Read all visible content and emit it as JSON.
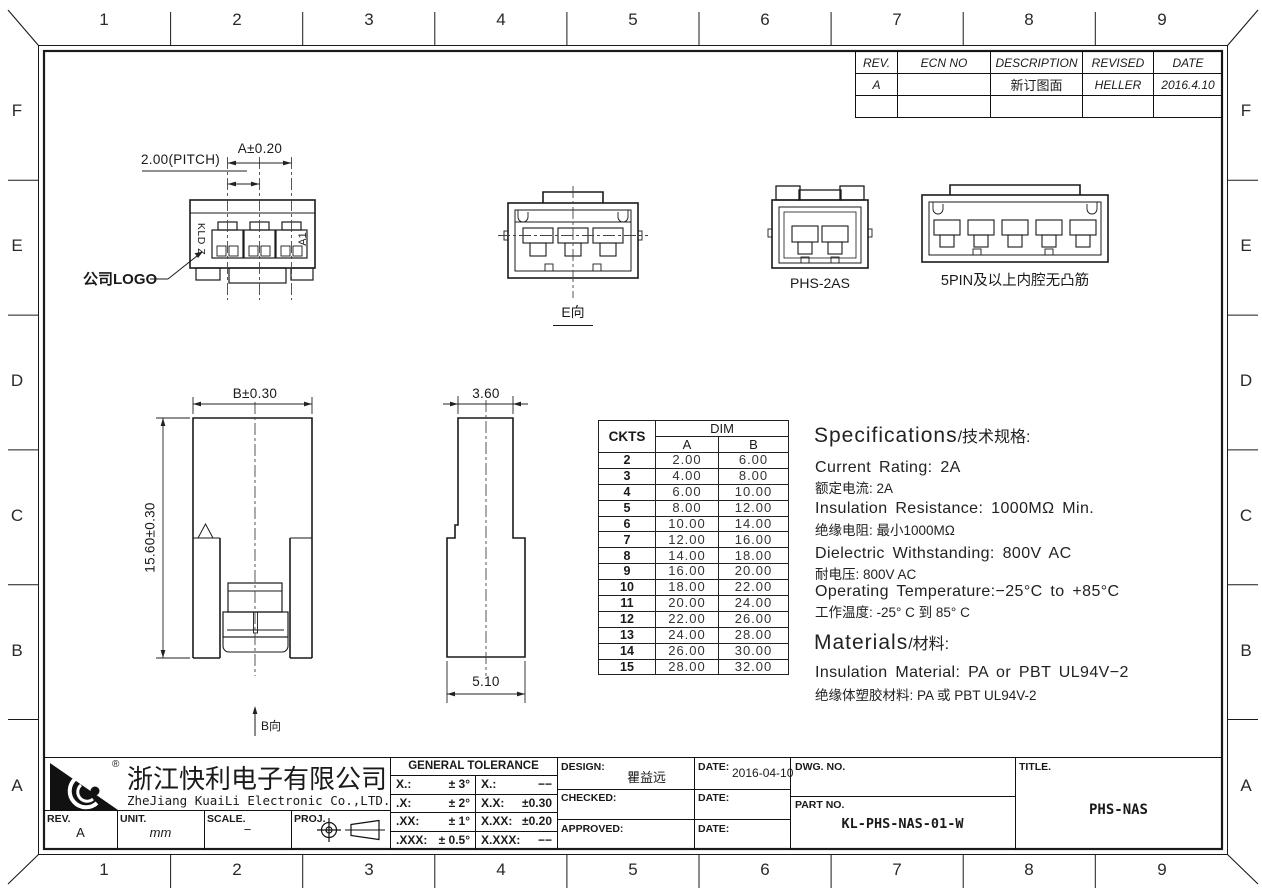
{
  "grid": {
    "cols": [
      "1",
      "2",
      "3",
      "4",
      "5",
      "6",
      "7",
      "8",
      "9"
    ],
    "rows": [
      "F",
      "E",
      "D",
      "C",
      "B",
      "A"
    ]
  },
  "revision_table": {
    "headers": [
      "REV.",
      "ECN NO",
      "DESCRIPTION",
      "REVISED",
      "DATE"
    ],
    "rows": [
      [
        "A",
        "",
        "新订图面",
        "HELLER",
        "2016.4.10"
      ],
      [
        "",
        "",
        "",
        "",
        ""
      ]
    ]
  },
  "views": {
    "top_view": {
      "pitch_dim": "2.00(PITCH)",
      "a_dim": "A±0.20",
      "left_marking": "KLD Z",
      "right_marking": "A1",
      "logo_callout": "公司LOGO"
    },
    "e_view": {
      "label": "E向"
    },
    "phs_2as": {
      "label": "PHS-2AS"
    },
    "five_pin": {
      "label": "5PIN及以上内腔无凸筋"
    },
    "b_view": {
      "width_dim": "B±0.30",
      "height_dim": "15.60±0.30",
      "label": "B向"
    },
    "side_view": {
      "top_dim": "3.60",
      "bottom_dim": "5.10"
    }
  },
  "dim_table": {
    "ckts_header": "CKTS",
    "dim_header": "DIM",
    "col_a": "A",
    "col_b": "B",
    "rows": [
      [
        "2",
        "2.00",
        "6.00"
      ],
      [
        "3",
        "4.00",
        "8.00"
      ],
      [
        "4",
        "6.00",
        "10.00"
      ],
      [
        "5",
        "8.00",
        "12.00"
      ],
      [
        "6",
        "10.00",
        "14.00"
      ],
      [
        "7",
        "12.00",
        "16.00"
      ],
      [
        "8",
        "14.00",
        "18.00"
      ],
      [
        "9",
        "16.00",
        "20.00"
      ],
      [
        "10",
        "18.00",
        "22.00"
      ],
      [
        "11",
        "20.00",
        "24.00"
      ],
      [
        "12",
        "22.00",
        "26.00"
      ],
      [
        "13",
        "24.00",
        "28.00"
      ],
      [
        "14",
        "26.00",
        "30.00"
      ],
      [
        "15",
        "28.00",
        "32.00"
      ]
    ]
  },
  "specs": {
    "title_en": "Specifications",
    "title_cn": "/技术规格:",
    "current_en": "Current Rating: 2A",
    "current_cn": "额定电流: 2A",
    "insulation_en": "Insulation Resistance: 1000MΩ Min.",
    "insulation_cn": "绝缘电阻: 最小1000MΩ",
    "dielectric_en": "Dielectric Withstanding: 800V AC",
    "dielectric_cn": "耐电压: 800V AC",
    "temp_en": "Operating Temperature:−25°C to +85°C",
    "temp_cn": "工作温度: -25° C 到 85° C",
    "materials_title_en": "Materials",
    "materials_title_cn": "/材料:",
    "material_en": "Insulation Material: PA or PBT UL94V−2",
    "material_cn": "绝缘体塑胶材料: PA 或 PBT UL94V-2"
  },
  "title_block": {
    "company_cn": "浙江快利电子有限公司",
    "company_en": "ZheJiang KuaiLi Electronic Co.,LTD.",
    "registered": "®",
    "rev_label": "REV.",
    "rev_value": "A",
    "unit_label": "UNIT.",
    "unit_value": "mm",
    "scale_label": "SCALE.",
    "scale_value": "−",
    "proj_label": "PROJ.",
    "tolerance_header": "GENERAL TOLERANCE",
    "tolerance_rows": [
      [
        "X.:",
        "± 3°",
        "X.:",
        "−−"
      ],
      [
        ".X:",
        "± 2°",
        "X.X:",
        "±0.30"
      ],
      [
        ".XX:",
        "± 1°",
        "X.XX:",
        "±0.20"
      ],
      [
        ".XXX:",
        "± 0.5°",
        "X.XXX:",
        "−−"
      ]
    ],
    "design_label": "DESIGN:",
    "design_value": "瞿益远",
    "design_date_label": "DATE:",
    "design_date_value": "2016-04-10",
    "checked_label": "CHECKED:",
    "checked_date_label": "DATE:",
    "approved_label": "APPROVED:",
    "approved_date_label": "DATE:",
    "dwg_no_label": "DWG. NO.",
    "part_no_label": "PART NO.",
    "part_no_value": "KL-PHS-NAS-01-W",
    "title_label": "TITLE.",
    "title_value": "PHS-NAS"
  }
}
